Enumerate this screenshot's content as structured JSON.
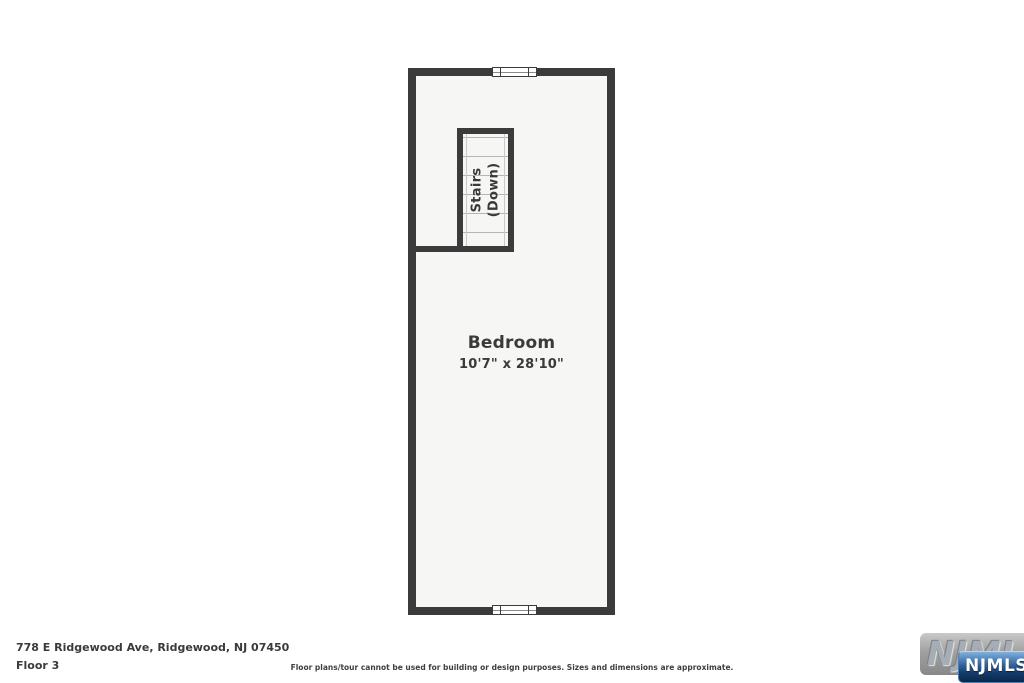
{
  "plan": {
    "room_name": "Bedroom",
    "room_dimensions": "10'7\" x 28'10\"",
    "stairs_line1": "Stairs",
    "stairs_line2": "(Down)"
  },
  "footer": {
    "address": "778 E Ridgewood Ave, Ridgewood, NJ 07450",
    "floor_label": "Floor 3",
    "disclaimer": "Floor plans/tour cannot be used for building or design purposes. Sizes and dimensions are approximate."
  },
  "logo": {
    "watermark_text": "NJMLS",
    "badge_text": "NJMLS"
  },
  "colors": {
    "wall": "#3b3b3b",
    "floor": "#f6f6f4",
    "step_line": "#b5b5b5",
    "text": "#3a3a3a",
    "badge_blue_top": "#7fb0e0",
    "badge_blue_bottom": "#0b2748",
    "watermark_gray": "#a0a0a0"
  }
}
